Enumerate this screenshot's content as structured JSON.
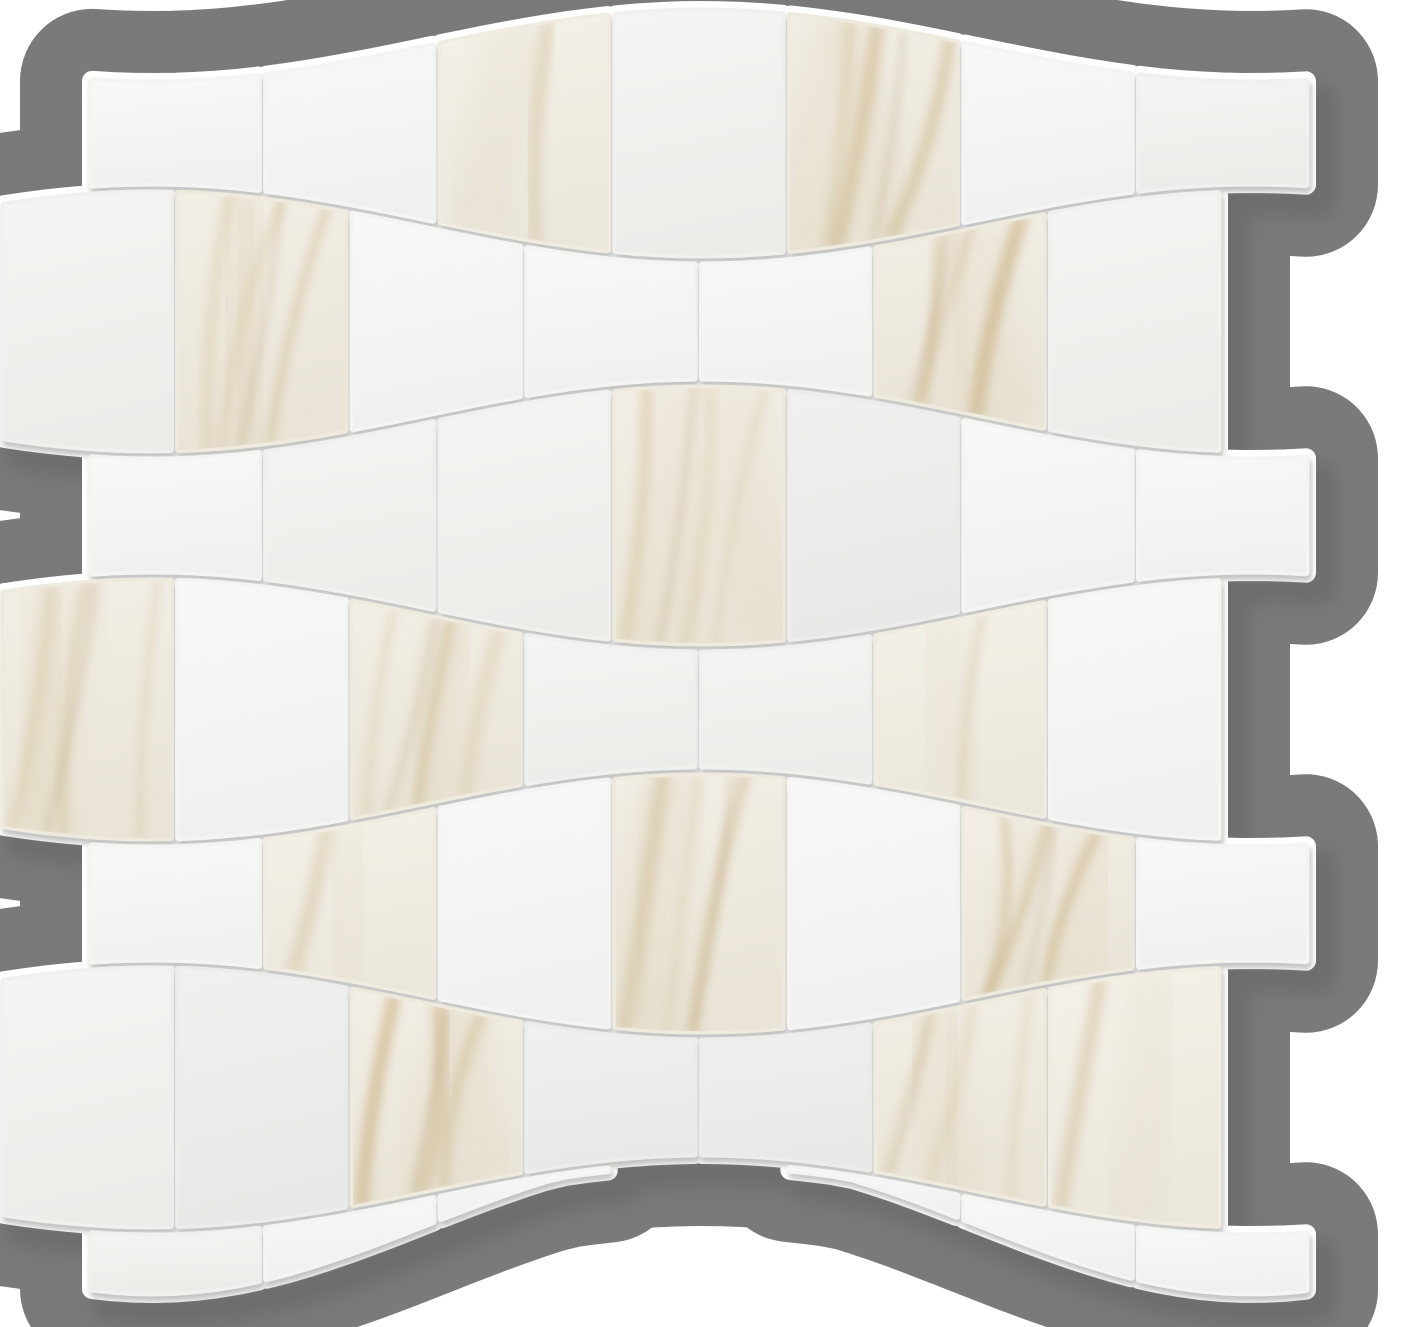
{
  "image": {
    "type": "product-photo",
    "subject": "wave-pattern-marble-mosaic-tile-sheet",
    "description": "White Calacatta marble-look mosaic tile sheet in an interlocking wave pattern with soft gold-beige veining and white grout, photographed on a gray backdrop",
    "background_color": "#ffffff",
    "backdrop_color": "#7a7a7a",
    "sheet_shadow_color": "#5e5e5e",
    "grout_color": "#ffffff",
    "tile_edge_shadow_color": "#8f8f8f"
  },
  "mosaic": {
    "canvas": {
      "width": 1405,
      "height": 1327
    },
    "wave": {
      "center_x": 702,
      "period": 1100
    },
    "lines": [
      {
        "mean": 42,
        "amp": -36
      },
      {
        "mean": 224,
        "amp": 36
      },
      {
        "mean": 419,
        "amp": -36
      },
      {
        "mean": 612,
        "amp": 36
      },
      {
        "mean": 807,
        "amp": -36
      },
      {
        "mean": 1000,
        "amp": 36
      },
      {
        "mean": 1195,
        "amp": -36
      },
      {
        "mean": 1229,
        "amp": -69
      }
    ],
    "rows": [
      {
        "top": 0,
        "bottom": 1,
        "origin": "inset"
      },
      {
        "top": 1,
        "bottom": 2,
        "origin": "flush"
      },
      {
        "top": 2,
        "bottom": 3,
        "origin": "inset"
      },
      {
        "top": 3,
        "bottom": 4,
        "origin": "flush"
      },
      {
        "top": 4,
        "bottom": 5,
        "origin": "inset"
      },
      {
        "top": 5,
        "bottom": 6,
        "origin": "flush"
      },
      {
        "top": 6,
        "bottom": 7,
        "origin": "inset",
        "sliver": true
      }
    ],
    "columns": {
      "count": 7,
      "tile_width": 174.57,
      "inset_x0": 88,
      "flush_x0": 0
    },
    "grout": {
      "gap_x": 4,
      "gap_y": 5,
      "rim_stroke": 20
    },
    "backdrop_dilation_stroke": 144,
    "sheet_shadow": {
      "dx": 16,
      "dy": 18,
      "blur": 9,
      "opacity": 0.45,
      "stroke": 30
    },
    "tile_shadow": {
      "dx": 2,
      "dy": 5,
      "blur": 3,
      "opacity": 0.55
    },
    "tile_gradients": [
      [
        "#f8f8f6",
        "#f0f0ee"
      ],
      [
        "#f4f4f2",
        "#ecece9"
      ],
      [
        "#f0f0ef",
        "#e8e8e7"
      ],
      [
        "#f4f1e9",
        "#ebe7dc"
      ],
      [
        "#f3efe7",
        "#e9e4d6"
      ]
    ],
    "vein_colors": {
      "core": "#c8ae7f",
      "soft": "#d9c8a4",
      "smudge": "#ddd0b4",
      "accent": "#b3946a"
    },
    "strong_veined_tiles": [
      [
        1,
        5
      ],
      [
        2,
        2
      ],
      [
        2,
        6
      ],
      [
        3,
        4
      ],
      [
        4,
        1
      ],
      [
        4,
        3
      ],
      [
        5,
        4
      ],
      [
        5,
        6
      ],
      [
        6,
        3
      ],
      [
        6,
        6
      ]
    ],
    "light_veined_tiles": [
      [
        1,
        3
      ],
      [
        5,
        2
      ],
      [
        4,
        6
      ],
      [
        6,
        7
      ]
    ],
    "gray_tiles": [
      [
        6,
        2
      ],
      [
        6,
        4
      ],
      [
        6,
        5
      ]
    ]
  }
}
